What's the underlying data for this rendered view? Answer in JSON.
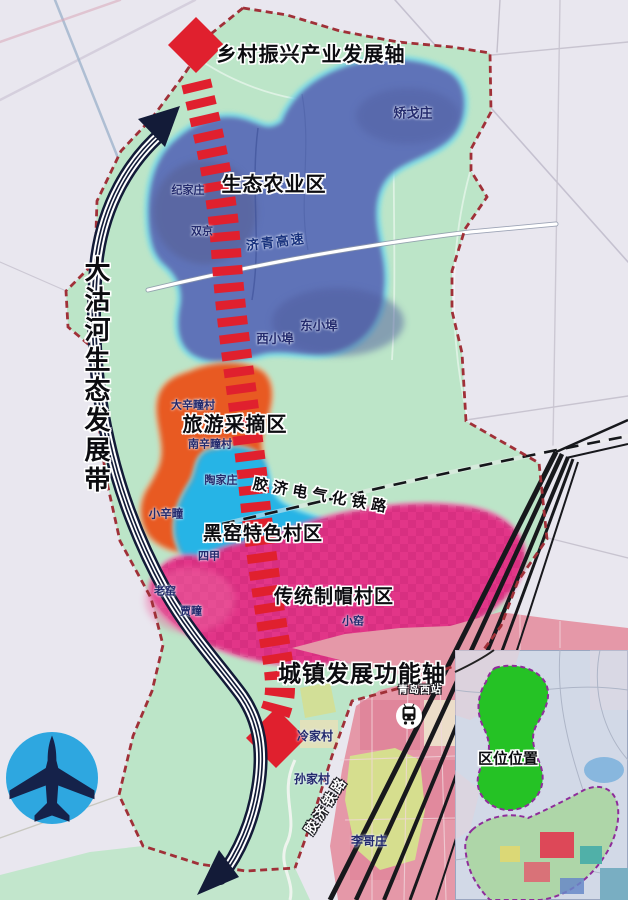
{
  "map": {
    "labels": {
      "axis_rural": "乡村振兴产业发展轴",
      "zone_agri": "生态农业区",
      "zone_tourism": "旅游采摘区",
      "zone_kiln": "黑窑特色村区",
      "zone_hats": "传统制帽村区",
      "axis_urban": "城镇发展功能轴",
      "belt_river": "大沽河生态发展带",
      "inset_title": "区位位置"
    },
    "roads": {
      "expressway": "济青高速",
      "electrified_railway": "胶济电气化铁路",
      "railway": "胶济铁路",
      "station": "青岛西站"
    },
    "villages": [
      "矫戈庄",
      "纪家庄",
      "双京",
      "东小埠",
      "西小埠",
      "大辛疃村",
      "南辛疃村",
      "陶家庄",
      "小辛疃",
      "四甲",
      "老窑",
      "贾疃",
      "小窑",
      "冷家村",
      "孙家村",
      "李哥庄"
    ],
    "icons": {
      "airplane": "airplane-icon",
      "station": "train-station-icon",
      "axis_arrows": "red-diamond-arrow",
      "belt_arrows": "navy-curved-arrow"
    },
    "colors": {
      "town_fill": "#bce5c8",
      "outside_fill": "#e9e7ef",
      "zone_agri": "#5e73b8",
      "zone_agri_glow": "#74d9e8",
      "zone_tourism": "#e85a22",
      "zone_kiln": "#28b4e6",
      "zone_hats": "#e23488",
      "axis_red": "#e0202e",
      "belt_navy": "#131b38",
      "boundary": "#a03038",
      "urban_pink": "#e598a8",
      "inset_green": "#25c225",
      "airplane_circle": "#2ea7e0"
    }
  }
}
